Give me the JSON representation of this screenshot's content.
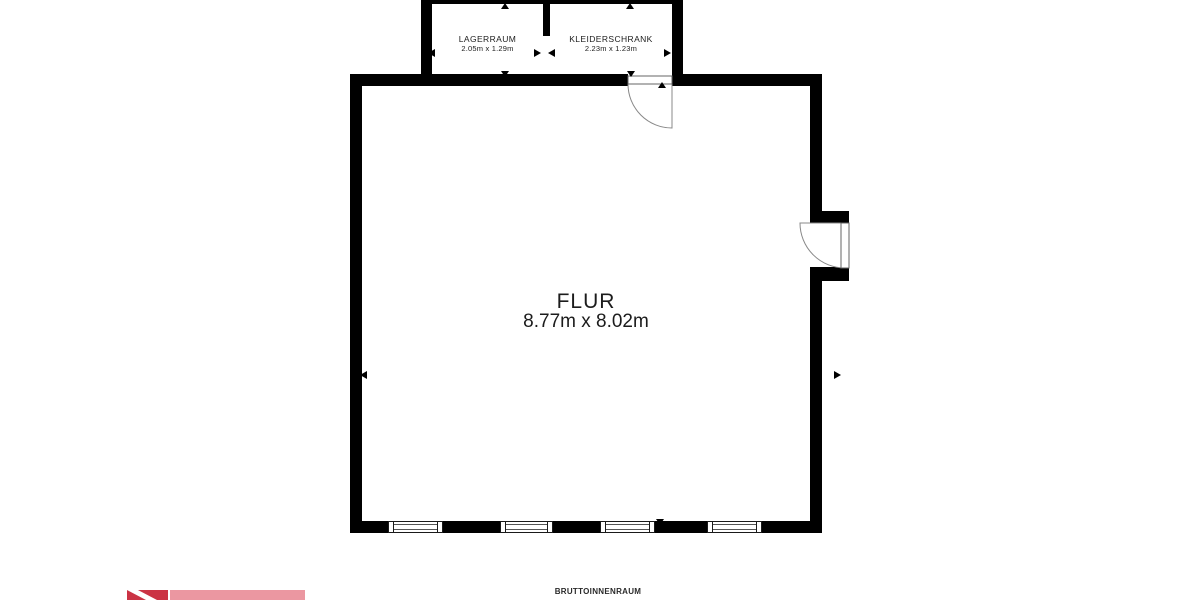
{
  "floorplan": {
    "main_room": {
      "name": "FLUR",
      "dimensions": "8.77m x 8.02m"
    },
    "rooms": [
      {
        "name": "LAGERRAUM",
        "dimensions": "2.05m x 1.29m"
      },
      {
        "name": "KLEIDERSCHRANK",
        "dimensions": "2.23m x 1.23m"
      }
    ],
    "symbols": {
      "dimension_arrow": "solid-triangle",
      "window": "double-line-window",
      "door": "quarter-circle-swing"
    },
    "colors": {
      "wall": "#000000",
      "door_stroke": "#888888",
      "text": "#1c1c1c",
      "logo_red": "#cb3344",
      "logo_pink": "#eb97a1"
    }
  },
  "footer": {
    "area_label": "BRUTTOINNENRAUM"
  }
}
